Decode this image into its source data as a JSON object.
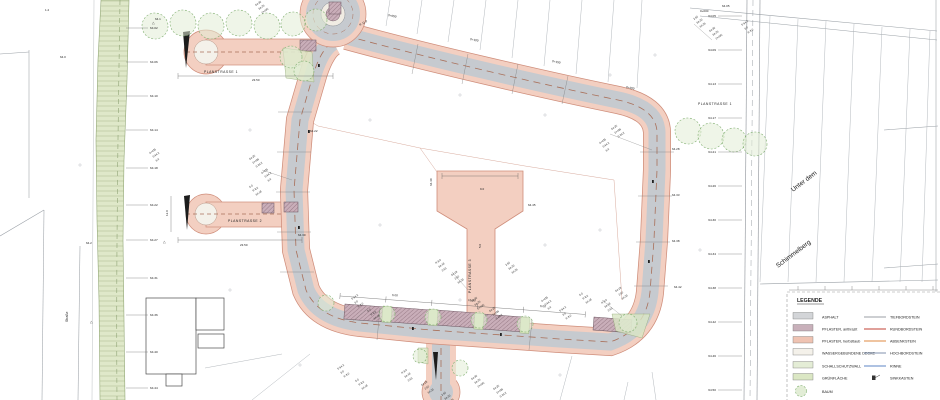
{
  "document_type": "Lageplan / Straßenplanung",
  "palette": {
    "paving_edge": "#f3cfc1",
    "paving_border": "#cf8d7a",
    "asphalt": "#c6cacf",
    "centerline": "#a9705a",
    "parking": "#c9aeb9",
    "green": "#dfe8c9",
    "tree": "#7fae6f",
    "parcel_line": "#9aa0a6"
  },
  "labels": {
    "planstrasse_top": "PLANSTRASSE 1",
    "planstrasse_right": "PLANSTRASSE 1",
    "planstrasse_mid": "PLANSTRASSE 2",
    "planstrasse_path": "PLANSTRASSE 3",
    "street_right_line1": "Unter dem",
    "street_right_line2": "Schimmelberg",
    "street_left": "Straße"
  },
  "legend": {
    "title": "LEGENDE",
    "surfaces": [
      {
        "label": "ASPHALT",
        "color": "#d3d5d8"
      },
      {
        "label": "PFLASTER, anthrazit",
        "color": "#c8b0ba"
      },
      {
        "label": "PFLASTER, herbstlaub",
        "color": "#efc3b2"
      },
      {
        "label": "WASSERGEBUNDENE DECKE",
        "color": "#f4f1ea"
      },
      {
        "label": "SCHALLSCHUTZWALL",
        "color": "#e4edd6"
      },
      {
        "label": "GRÜNFLÄCHE",
        "color": "#dbe7c4"
      },
      {
        "label": "BAUM",
        "color": "#e2edd6"
      }
    ],
    "lines": [
      {
        "label": "TIEFBORDSTEIN",
        "color": "#9b9fa4"
      },
      {
        "label": "RUNDBORDSTEIN",
        "color": "#c14236"
      },
      {
        "label": "ABSENKSTEIN",
        "color": "#df8a40"
      },
      {
        "label": "HOCHBORDSTEIN",
        "color": "#8091ad"
      },
      {
        "label": "RINNE",
        "color": "#5d84c4"
      },
      {
        "label": "SINKKASTEN",
        "color": "#333333"
      }
    ]
  },
  "plan": {
    "marker_glyph": "△",
    "cluster_texts": [
      "64.30",
      "64.25",
      "0+435",
      "S 64.2",
      "6.0",
      "R 8.0",
      "64.18",
      "2.50"
    ],
    "left_ticks": [
      [
        28,
        "64.02"
      ],
      [
        62,
        "64.06"
      ],
      [
        96,
        "64.10"
      ],
      [
        130,
        "64.14"
      ],
      [
        168,
        "64.18"
      ],
      [
        205,
        "64.22"
      ],
      [
        240,
        "64.27"
      ],
      [
        278,
        "64.31"
      ],
      [
        315,
        "64.36"
      ],
      [
        352,
        "64.40"
      ],
      [
        388,
        "64.44"
      ]
    ],
    "right_ticks": [
      [
        16,
        "64.05"
      ],
      [
        50,
        "64.09"
      ],
      [
        84,
        "64.13"
      ],
      [
        118,
        "64.17"
      ],
      [
        152,
        "64.21"
      ],
      [
        186,
        "64.26"
      ],
      [
        220,
        "64.30"
      ],
      [
        254,
        "64.34"
      ],
      [
        288,
        "64.38"
      ],
      [
        322,
        "64.42"
      ],
      [
        356,
        "64.46"
      ],
      [
        390,
        "64.50"
      ]
    ],
    "annotations": [
      [
        388,
        16,
        12,
        "0+050"
      ],
      [
        470,
        40,
        12,
        "0+100"
      ],
      [
        552,
        62,
        12,
        "0+150"
      ],
      [
        626,
        88,
        12,
        "0+200"
      ],
      [
        700,
        12,
        0,
        "0+000"
      ],
      [
        722,
        7,
        0,
        "64.05"
      ],
      [
        672,
        150,
        0,
        "64.28"
      ],
      [
        672,
        196,
        0,
        "64.33"
      ],
      [
        672,
        242,
        0,
        "64.38"
      ],
      [
        674,
        288,
        0,
        "64.42"
      ],
      [
        392,
        296,
        4,
        "6.00"
      ],
      [
        468,
        301,
        4,
        "16.50"
      ],
      [
        540,
        307,
        4,
        "6.00"
      ],
      [
        480,
        190,
        0,
        "9.0"
      ],
      [
        481,
        248,
        -90,
        "5.0"
      ],
      [
        252,
        81,
        0,
        "23.50"
      ],
      [
        240,
        246,
        0,
        "23.50"
      ],
      [
        168,
        216,
        -90,
        "12.0"
      ],
      [
        360,
        26,
        -30,
        "R 11.0"
      ],
      [
        86,
        244,
        0,
        "64.2"
      ],
      [
        60,
        58,
        0,
        "64.0"
      ],
      [
        45,
        11,
        0,
        "1.2"
      ],
      [
        155,
        20,
        0,
        "64.1"
      ],
      [
        528,
        206,
        0,
        "64.45"
      ],
      [
        432,
        186,
        -90,
        "64.40"
      ],
      [
        310,
        132,
        0,
        "64.22"
      ],
      [
        298,
        236,
        0,
        "64.30"
      ]
    ],
    "clusters": [
      [
        256,
        6
      ],
      [
        250,
        160
      ],
      [
        262,
        174
      ],
      [
        352,
        300
      ],
      [
        368,
        312
      ],
      [
        436,
        264
      ],
      [
        452,
        276
      ],
      [
        506,
        266
      ],
      [
        472,
        302
      ],
      [
        490,
        312
      ],
      [
        542,
        302
      ],
      [
        560,
        312
      ],
      [
        580,
        296
      ],
      [
        602,
        304
      ],
      [
        616,
        292
      ],
      [
        694,
        20
      ],
      [
        710,
        32
      ],
      [
        612,
        130
      ],
      [
        600,
        144
      ],
      [
        338,
        370
      ],
      [
        356,
        382
      ],
      [
        402,
        374
      ],
      [
        422,
        386
      ],
      [
        442,
        396
      ],
      [
        472,
        380
      ],
      [
        494,
        390
      ],
      [
        150,
        154
      ],
      [
        742,
        26
      ],
      [
        250,
        188
      ]
    ],
    "boundary_lines": [
      [
        29,
        50,
        29,
        198
      ],
      [
        0,
        236,
        44,
        210
      ],
      [
        44,
        210,
        42,
        400
      ],
      [
        80,
        246,
        78,
        400
      ],
      [
        0,
        54,
        29,
        52
      ],
      [
        690,
        8,
        937,
        31
      ],
      [
        700,
        16,
        937,
        40
      ],
      [
        760,
        284,
        938,
        280
      ],
      [
        936,
        0,
        936,
        400
      ],
      [
        884,
        130,
        938,
        126
      ],
      [
        884,
        268,
        938,
        264
      ]
    ],
    "parcel_lines": [
      [
        390,
        0,
        386,
        26
      ],
      [
        422,
        0,
        417,
        34
      ],
      [
        454,
        0,
        448,
        42
      ],
      [
        486,
        0,
        480,
        50
      ],
      [
        518,
        0,
        512,
        58
      ],
      [
        550,
        0,
        544,
        66
      ],
      [
        582,
        0,
        576,
        74
      ],
      [
        614,
        0,
        608,
        82
      ],
      [
        642,
        0,
        637,
        88
      ],
      [
        770,
        16,
        760,
        282
      ],
      [
        798,
        19,
        788,
        282
      ],
      [
        826,
        21,
        816,
        282
      ],
      [
        854,
        24,
        844,
        282
      ],
      [
        882,
        27,
        872,
        282
      ],
      [
        910,
        29,
        900,
        282
      ],
      [
        930,
        31,
        922,
        282
      ]
    ],
    "lot_lines": [
      [
        318,
        126,
        420,
        148
      ],
      [
        420,
        148,
        525,
        166
      ],
      [
        525,
        166,
        614,
        180
      ],
      [
        420,
        148,
        437,
        172
      ],
      [
        614,
        180,
        622,
        300
      ],
      [
        318,
        126,
        308,
        120
      ]
    ],
    "south_lines": [
      [
        252,
        400,
        310,
        354
      ],
      [
        205,
        368,
        282,
        354
      ],
      [
        560,
        400,
        572,
        356
      ],
      [
        628,
        382,
        624,
        400
      ],
      [
        652,
        372,
        656,
        400
      ]
    ],
    "road_ticks": [
      [
        278,
        112,
        312,
        112
      ],
      [
        277,
        152,
        311,
        152
      ],
      [
        276,
        192,
        310,
        192
      ],
      [
        277,
        232,
        311,
        232
      ],
      [
        280,
        272,
        314,
        272
      ],
      [
        640,
        152,
        674,
        152
      ],
      [
        638,
        196,
        672,
        196
      ],
      [
        636,
        242,
        670,
        242
      ],
      [
        634,
        286,
        668,
        286
      ],
      [
        418,
        44,
        412,
        74
      ],
      [
        468,
        54,
        462,
        84
      ],
      [
        518,
        64,
        512,
        94
      ],
      [
        568,
        76,
        562,
        104
      ],
      [
        380,
        308,
        377,
        340
      ],
      [
        532,
        320,
        529,
        350
      ]
    ],
    "leader_lines": [
      [
        262,
        170,
        292,
        180
      ],
      [
        368,
        308,
        352,
        322
      ],
      [
        452,
        272,
        468,
        290
      ],
      [
        602,
        300,
        622,
        316
      ],
      [
        694,
        24,
        712,
        40
      ],
      [
        610,
        134,
        652,
        150
      ]
    ],
    "buildings": [
      [
        146,
        298,
        50,
        76
      ],
      [
        196,
        298,
        28,
        32
      ],
      [
        198,
        334,
        26,
        14
      ],
      [
        166,
        374,
        16,
        12
      ]
    ],
    "bays": [
      [
        345,
        304,
        44,
        15,
        4.3
      ],
      [
        391,
        307,
        44,
        15,
        4.3
      ],
      [
        437,
        310,
        44,
        15,
        4.3
      ],
      [
        483,
        314,
        44,
        15,
        4.3
      ],
      [
        594,
        317,
        38,
        13,
        4.3
      ],
      [
        300,
        40,
        16,
        11,
        0
      ],
      [
        329,
        2,
        12,
        12,
        0
      ],
      [
        262,
        203,
        12,
        10,
        0
      ],
      [
        284,
        202,
        14,
        10,
        0
      ]
    ],
    "islands": [
      [
        383,
        306,
        9,
        16,
        4.3
      ],
      [
        429,
        309,
        9,
        16,
        4.3
      ],
      [
        475,
        313,
        9,
        16,
        4.3
      ],
      [
        521,
        317,
        9,
        16,
        4.3
      ]
    ],
    "green_polys": [
      "612,314 650,314 642,338 616,331",
      "418,348 428,348 428,364 418,362",
      "283,48 312,52 314,82 286,78"
    ],
    "black_wedges": [
      "183,32 190,31 186,68",
      "184,196 190,195 187,230",
      "433,352 438,352 436,380"
    ],
    "trees": [
      [
        155,
        26,
        13
      ],
      [
        183,
        23,
        13
      ],
      [
        211,
        26,
        13
      ],
      [
        239,
        23,
        13
      ],
      [
        267,
        26,
        13
      ],
      [
        293,
        24,
        12
      ],
      [
        316,
        20,
        11
      ],
      [
        291,
        57,
        11
      ],
      [
        304,
        71,
        10
      ],
      [
        688,
        131,
        13
      ],
      [
        711,
        136,
        13
      ],
      [
        734,
        140,
        12
      ],
      [
        755,
        144,
        12
      ],
      [
        387,
        314,
        8
      ],
      [
        433,
        317,
        8
      ],
      [
        479,
        320,
        8
      ],
      [
        525,
        324,
        8
      ],
      [
        628,
        323,
        9
      ],
      [
        420,
        356,
        7
      ],
      [
        460,
        368,
        8
      ],
      [
        326,
        303,
        8
      ]
    ],
    "crosses": [
      [
        370,
        120
      ],
      [
        460,
        95
      ],
      [
        545,
        115
      ],
      [
        610,
        75
      ],
      [
        250,
        130
      ],
      [
        230,
        290
      ],
      [
        380,
        225
      ],
      [
        545,
        245
      ],
      [
        300,
        365
      ],
      [
        560,
        375
      ],
      [
        655,
        55
      ],
      [
        460,
        300
      ],
      [
        700,
        250
      ],
      [
        80,
        165
      ],
      [
        600,
        230
      ]
    ],
    "sink_boxes": [
      [
        318,
        64
      ],
      [
        298,
        226
      ],
      [
        412,
        327
      ],
      [
        500,
        333
      ],
      [
        648,
        260
      ],
      [
        652,
        180
      ],
      [
        308,
        130
      ]
    ],
    "markers": [
      [
        90,
        323
      ],
      [
        152,
        24
      ],
      [
        163,
        243
      ]
    ]
  }
}
